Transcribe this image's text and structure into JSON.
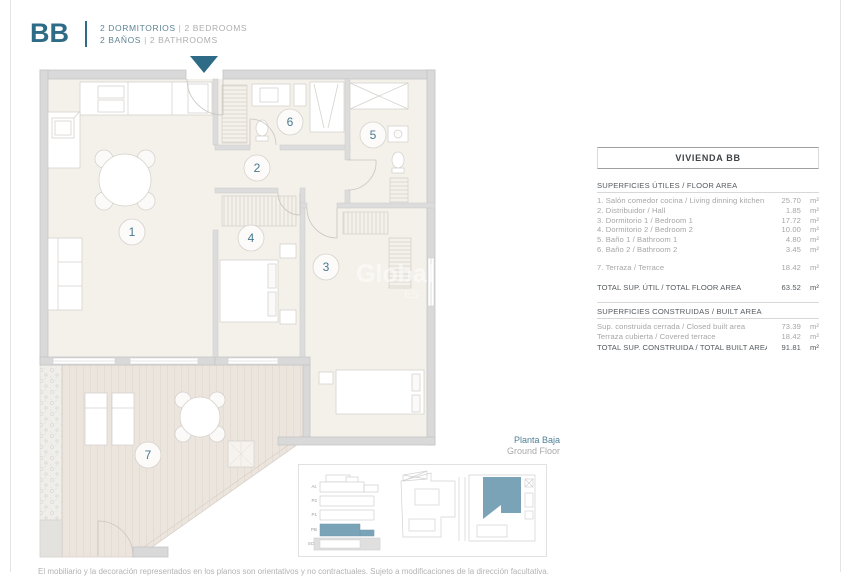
{
  "header": {
    "unit_code": "BB",
    "line1_es": "2 DORMITORIOS",
    "line1_en": "2 BEDROOMS",
    "line2_es": "2 BAÑOS",
    "line2_en": "2 BATHROOMS",
    "sep": "|"
  },
  "plan": {
    "room_numbers": [
      "1",
      "2",
      "3",
      "4",
      "5",
      "6",
      "7"
    ],
    "watermark_line1": "Global",
    "watermark_line2": "ES",
    "floor_label_es": "Planta Baja",
    "floor_label_en": "Ground Floor"
  },
  "table": {
    "title": "VIVIENDA BB",
    "unit": "m²",
    "section1": {
      "header": "SUPERFICIES ÚTILES / FLOOR AREA",
      "rows": [
        {
          "label": "1. Salón comedor cocina / Living dinning kitchen",
          "value": "25.70"
        },
        {
          "label": "2. Distribuidor / Hall",
          "value": "1.85"
        },
        {
          "label": "3. Dormitorio 1 / Bedroom 1",
          "value": "17.72"
        },
        {
          "label": "4. Dormitorio 2 / Bedroom 2",
          "value": "10.00"
        },
        {
          "label": "5. Baño 1 / Bathroom 1",
          "value": "4.80"
        },
        {
          "label": "6. Baño 2 / Bathroom 2",
          "value": "3.45"
        },
        {
          "label": "7. Terraza / Terrace",
          "value": "18.42"
        }
      ],
      "total_label": "TOTAL SUP. ÚTIL / TOTAL FLOOR AREA",
      "total_value": "63.52"
    },
    "section2": {
      "header": "SUPERFICIES CONSTRUIDAS / BUILT AREA",
      "rows": [
        {
          "label": "Sup. construida cerrada / Closed built area",
          "value": "73.39"
        },
        {
          "label": "Terraza cubierta / Covered terrace",
          "value": "18.42"
        }
      ],
      "total_label": "TOTAL SUP. CONSTRUIDA /  TOTAL BUILT AREA",
      "total_value": "91.81"
    }
  },
  "key_diagrams": {
    "section_labels": [
      "At.",
      "P2",
      "P1",
      "PB",
      "SOT"
    ]
  },
  "footer": {
    "disclaimer": "El mobiliario y la decoración representados en los planos son orientativos y no contractuales. Sujeto a modificaciones de la dirección facultativa."
  },
  "colors": {
    "accent": "#2e6b87",
    "highlight": "#7ba3b7"
  }
}
